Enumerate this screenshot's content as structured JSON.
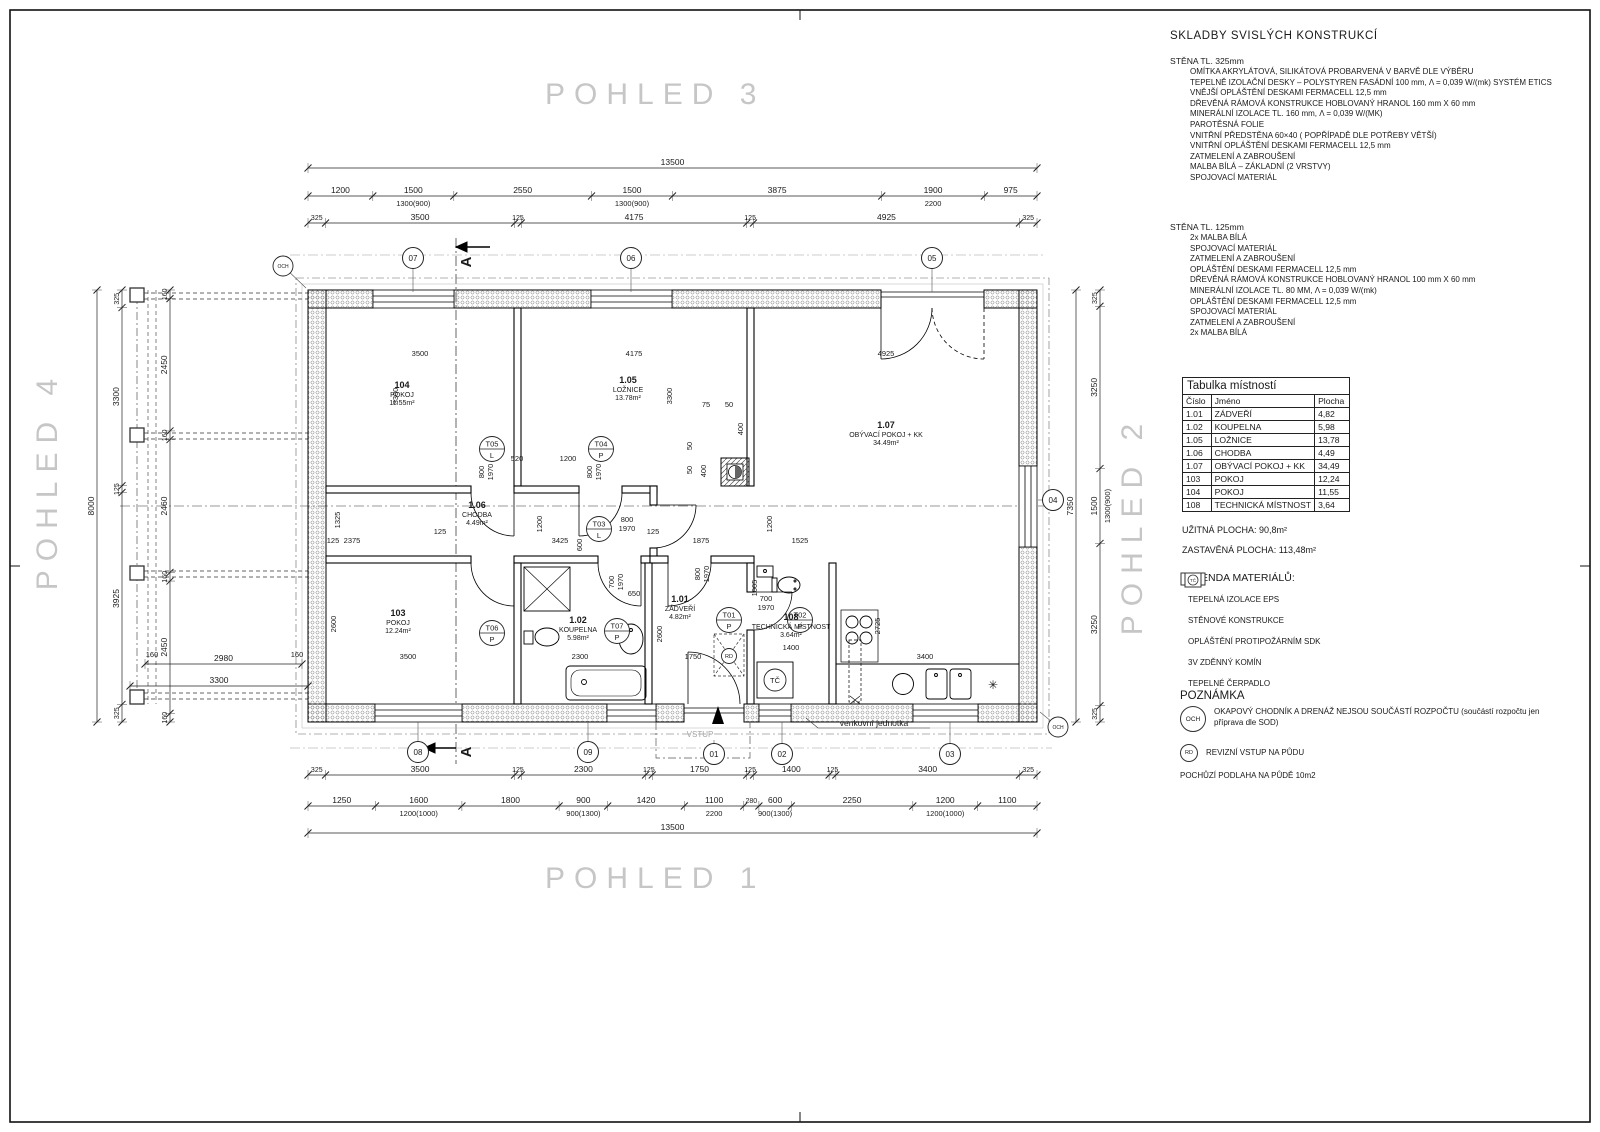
{
  "titles": {
    "view3": "POHLED 3",
    "view1": "POHLED 1",
    "view4": "POHLED 4",
    "view2": "POHLED 2"
  },
  "right_panel": {
    "skladby_title": "SKLADBY SVISLÝCH KONSTRUKCÍ",
    "wall325": {
      "heading": "STĚNA TL. 325mm",
      "lines": [
        "OMÍTKA AKRYLÁTOVÁ, SILIKÁTOVÁ PROBARVENÁ V BARVĚ DLE VÝBĚRU",
        "TEPELNĚ IZOLAČNÍ DESKY – POLYSTYREN FASÁDNÍ 100 mm, Λ = 0,039 W/(mk) SYSTÉM ETICS",
        "VNĚJŠÍ OPLÁŠTĚNÍ DESKAMI FERMACELL 12,5 mm",
        "DŘEVĚNÁ RÁMOVÁ KONSTRUKCE HOBLOVANÝ HRANOL 160 mm X 60 mm",
        "MINERÁLNÍ IZOLACE TL. 160 mm, Λ = 0,039 W/(MK)",
        "PAROTĚSNÁ FOLIE",
        "VNITŘNÍ PŘEDSTĚNA 60×40 ( POPŘÍPADĚ DLE POTŘEBY VĚTŠÍ)",
        "VNITŘNÍ OPLÁŠTĚNÍ DESKAMI FERMACELL 12,5 mm",
        "ZATMELENÍ A ZABROUŠENÍ",
        "MALBA BÍLÁ – ZÁKLADNÍ (2 VRSTVY)",
        "SPOJOVACÍ MATERIÁL"
      ]
    },
    "wall125": {
      "heading": "STĚNA TL. 125mm",
      "lines": [
        "2x MALBA BÍLÁ",
        "SPOJOVACÍ MATERIÁL",
        "ZATMELENÍ A ZABROUŠENÍ",
        "OPLÁŠTĚNÍ DESKAMI FERMACELL 12,5 mm",
        "DŘEVĚNÁ RÁMOVÁ KONSTRUKCE HOBLOVANÝ HRANOL 100 mm X 60 mm",
        "MINERÁLNÍ IZOLACE TL. 80 MM, Λ = 0,039 W/(mk)",
        "OPLÁŠTĚNÍ DESKAMI FERMACELL 12,5 mm",
        "SPOJOVACÍ MATERIÁL",
        "ZATMELENÍ A ZABROUŠENÍ",
        "2x MALBA BÍLÁ"
      ]
    },
    "room_table": {
      "title": "Tabulka místností",
      "headers": [
        "Číslo",
        "Jméno",
        "Plocha"
      ],
      "rows": [
        [
          "1.01",
          "ZÁDVEŘÍ",
          "4,82"
        ],
        [
          "1.02",
          "KOUPELNA",
          "5,98"
        ],
        [
          "1.05",
          "LOŽNICE",
          "13,78"
        ],
        [
          "1.06",
          "CHODBA",
          "4,49"
        ],
        [
          "1.07",
          "OBÝVACÍ POKOJ + KK",
          "34,49"
        ],
        [
          "103",
          "POKOJ",
          "12,24"
        ],
        [
          "104",
          "POKOJ",
          "11,55"
        ],
        [
          "108",
          "TECHNICKÁ MÍSTNOST",
          "3,64"
        ]
      ]
    },
    "area_line1": "UŽITNÁ PLOCHA:  90,8m²",
    "area_line2": "ZASTAVĚNÁ PLOCHA: 113,48m²",
    "legend": {
      "title": "LEGENDA MATERIÁLŮ:",
      "tc_symbol": "TČ",
      "items": [
        {
          "type": "eps",
          "label": "TEPELNÁ IZOLACE EPS"
        },
        {
          "type": "wall",
          "label": "STĚNOVÉ KONSTRUKCE"
        },
        {
          "type": "sdk",
          "label": "OPLÁŠTĚNÍ PROTIPOŽÁRNÍM SDK"
        },
        {
          "type": "chimney",
          "label": "3V ZDĚNNÝ KOMÍN"
        },
        {
          "type": "pump",
          "label": "TEPELNÉ ČERPADLO"
        }
      ]
    },
    "note": {
      "title": "POZNÁMKA",
      "och_badge": "OCH",
      "och_text": "OKAPOVÝ CHODNÍK A DRENÁŽ NEJSOU SOUČÁSTÍ ROZPOČTU (součástí rozpočtu jen příprava dle SOD)",
      "rd_badge": "RD",
      "rd_text": "REVIZNÍ VSTUP NA PŮDU",
      "floor_text": "POCHŮZÍ PODLAHA NA PŮDĚ 10m2"
    }
  },
  "plan": {
    "rooms": [
      {
        "id": "104",
        "name": "POKOJ",
        "area": "11.55m²",
        "x": 402,
        "y": 388
      },
      {
        "id": "1.05",
        "name": "LOŽNICE",
        "area": "13.78m²",
        "x": 628,
        "y": 383
      },
      {
        "id": "1.07",
        "name": "OBÝVACÍ POKOJ + KK",
        "area": "34.49m²",
        "x": 886,
        "y": 428
      },
      {
        "id": "1.06",
        "name": "CHODBA",
        "area": "4.49m²",
        "x": 477,
        "y": 508
      },
      {
        "id": "103",
        "name": "POKOJ",
        "area": "12.24m²",
        "x": 398,
        "y": 616
      },
      {
        "id": "1.02",
        "name": "KOUPELNA",
        "area": "5.98m²",
        "x": 578,
        "y": 623
      },
      {
        "id": "1.01",
        "name": "ZÁDVEŘÍ",
        "area": "4.82m²",
        "x": 680,
        "y": 602
      },
      {
        "id": "108",
        "name": "TECHNICKÁ MÍSTNOST",
        "area": "3.64m²",
        "x": 791,
        "y": 620
      }
    ],
    "door_tags": [
      {
        "t": "T05",
        "s": "L",
        "x": 492,
        "y": 449
      },
      {
        "t": "T04",
        "s": "P",
        "x": 601,
        "y": 449
      },
      {
        "t": "T03",
        "s": "L",
        "x": 599,
        "y": 529
      },
      {
        "t": "T06",
        "s": "P",
        "x": 492,
        "y": 633
      },
      {
        "t": "T07",
        "s": "P",
        "x": 617,
        "y": 631
      },
      {
        "t": "T01",
        "s": "P",
        "x": 729,
        "y": 620
      },
      {
        "t": "T02",
        "s": "P",
        "x": 800,
        "y": 620
      }
    ],
    "markers": [
      {
        "t": "07",
        "x": 413,
        "y": 258,
        "lx": 413,
        "ly": 292
      },
      {
        "t": "06",
        "x": 631,
        "y": 258,
        "lx": 631,
        "ly": 292
      },
      {
        "t": "05",
        "x": 932,
        "y": 258,
        "lx": 932,
        "ly": 292
      },
      {
        "t": "04",
        "x": 1053,
        "y": 500,
        "lx": 1038,
        "ly": 500
      },
      {
        "t": "08",
        "x": 418,
        "y": 752,
        "lx": 418,
        "ly": 722
      },
      {
        "t": "09",
        "x": 588,
        "y": 752,
        "lx": 588,
        "ly": 722
      },
      {
        "t": "01",
        "x": 714,
        "y": 754,
        "lx": 714,
        "ly": 740
      },
      {
        "t": "02",
        "x": 782,
        "y": 754,
        "lx": 782,
        "ly": 722
      },
      {
        "t": "03",
        "x": 950,
        "y": 754,
        "lx": 950,
        "ly": 722
      }
    ],
    "badges": [
      {
        "t": "OCH",
        "x": 283,
        "y": 266,
        "r": 10,
        "s": 5,
        "lx": 306,
        "ly": 288
      },
      {
        "t": "OCH",
        "x": 1058,
        "y": 727,
        "r": 10,
        "s": 5,
        "lx": 1040,
        "ly": 712
      },
      {
        "t": "RD",
        "x": 729,
        "y": 656,
        "r": 7.5,
        "s": 5.5
      },
      {
        "t": "TČ",
        "x": 775,
        "y": 680,
        "r": 11,
        "s": 7.5
      }
    ],
    "chains": [
      {
        "o": "h",
        "pos": 168,
        "from": 308,
        "to": 1037,
        "segs": [
          {
            "v": "13500"
          }
        ]
      },
      {
        "o": "h",
        "pos": 196,
        "from": 308,
        "to": 1037,
        "segs": [
          {
            "v": "1200"
          },
          {
            "v": "1500",
            "sub": "1300(900)"
          },
          {
            "v": "2550"
          },
          {
            "v": "1500",
            "sub": "1300(900)"
          },
          {
            "v": "3875"
          },
          {
            "v": "1900",
            "sub": "2200"
          },
          {
            "v": "975"
          }
        ]
      },
      {
        "o": "h",
        "pos": 223,
        "from": 308,
        "to": 1037,
        "segs": [
          {
            "v": "325"
          },
          {
            "v": "3500"
          },
          {
            "v": "125"
          },
          {
            "v": "4175"
          },
          {
            "v": "125"
          },
          {
            "v": "4925"
          },
          {
            "v": "325"
          }
        ]
      },
      {
        "o": "h",
        "pos": 775,
        "from": 308,
        "to": 1037,
        "segs": [
          {
            "v": "325"
          },
          {
            "v": "3500"
          },
          {
            "v": "125"
          },
          {
            "v": "2300"
          },
          {
            "v": "125"
          },
          {
            "v": "1750"
          },
          {
            "v": "125"
          },
          {
            "v": "1400"
          },
          {
            "v": "125"
          },
          {
            "v": "3400"
          },
          {
            "v": "325"
          }
        ]
      },
      {
        "o": "h",
        "pos": 806,
        "from": 308,
        "to": 1037,
        "segs": [
          {
            "v": "1250"
          },
          {
            "v": "1600",
            "sub": "1200(1000)"
          },
          {
            "v": "1800"
          },
          {
            "v": "900",
            "sub": "900(1300)"
          },
          {
            "v": "1420"
          },
          {
            "v": "1100",
            "sub": "2200"
          },
          {
            "v": "280"
          },
          {
            "v": "600",
            "sub": "900(1300)"
          },
          {
            "v": "2250"
          },
          {
            "v": "1200",
            "sub": "1200(1000)"
          },
          {
            "v": "1100"
          }
        ]
      },
      {
        "o": "h",
        "pos": 833,
        "from": 308,
        "to": 1037,
        "segs": [
          {
            "v": "13500"
          }
        ]
      },
      {
        "o": "v",
        "pos": 97,
        "from": 290,
        "to": 722,
        "segs": [
          {
            "v": "8000"
          }
        ]
      },
      {
        "o": "v",
        "pos": 122,
        "from": 290,
        "to": 722,
        "segs": [
          {
            "v": "325"
          },
          {
            "v": "3300"
          },
          {
            "v": "125"
          },
          {
            "v": "3925"
          },
          {
            "v": "325"
          }
        ]
      },
      {
        "o": "v",
        "pos": 170,
        "from": 290,
        "to": 722,
        "segs": [
          {
            "v": "160"
          },
          {
            "v": "2450"
          },
          {
            "v": "160"
          },
          {
            "v": "2460"
          },
          {
            "v": "160"
          },
          {
            "v": "2450"
          },
          {
            "v": "160"
          }
        ]
      },
      {
        "o": "v",
        "pos": 1076,
        "from": 290,
        "to": 722,
        "segs": [
          {
            "v": "7350"
          }
        ]
      },
      {
        "o": "v",
        "pos": 1100,
        "from": 290,
        "to": 722,
        "segs": [
          {
            "v": "325"
          },
          {
            "v": "3250"
          },
          {
            "v": "1500",
            "sub": "1300(900)"
          },
          {
            "v": "3250"
          },
          {
            "v": "325"
          }
        ]
      },
      {
        "o": "h",
        "pos": 664,
        "from": 145,
        "to": 302,
        "segs": [
          {
            "v": "2980"
          }
        ]
      },
      {
        "o": "h",
        "pos": 686,
        "from": 130,
        "to": 308,
        "segs": [
          {
            "v": "3300"
          }
        ]
      }
    ],
    "dims": [
      {
        "t": "3500",
        "x": 420,
        "y": 356
      },
      {
        "t": "4175",
        "x": 634,
        "y": 356
      },
      {
        "t": "4925",
        "x": 886,
        "y": 356
      },
      {
        "t": "3300",
        "x": 398,
        "y": 396,
        "r": 1
      },
      {
        "t": "3300",
        "x": 672,
        "y": 396,
        "r": 1
      },
      {
        "t": "520",
        "x": 517,
        "y": 461
      },
      {
        "t": "1200",
        "x": 568,
        "y": 461
      },
      {
        "t": "800",
        "x": 484,
        "y": 472,
        "r": 1
      },
      {
        "t": "1970",
        "x": 493,
        "y": 472,
        "r": 1
      },
      {
        "t": "800",
        "x": 592,
        "y": 472,
        "r": 1
      },
      {
        "t": "1970",
        "x": 601,
        "y": 472,
        "r": 1
      },
      {
        "t": "75",
        "x": 706,
        "y": 407
      },
      {
        "t": "50",
        "x": 729,
        "y": 407
      },
      {
        "t": "400",
        "x": 743,
        "y": 429,
        "r": 1
      },
      {
        "t": "50",
        "x": 692,
        "y": 446,
        "r": 1
      },
      {
        "t": "400",
        "x": 706,
        "y": 471,
        "r": 1
      },
      {
        "t": "50",
        "x": 692,
        "y": 470,
        "r": 1
      },
      {
        "t": "1325",
        "x": 340,
        "y": 520,
        "r": 1
      },
      {
        "t": "2375",
        "x": 352,
        "y": 543
      },
      {
        "t": "125",
        "x": 440,
        "y": 534
      },
      {
        "t": "3425",
        "x": 560,
        "y": 543
      },
      {
        "t": "1875",
        "x": 701,
        "y": 543
      },
      {
        "t": "1525",
        "x": 800,
        "y": 543
      },
      {
        "t": "1200",
        "x": 542,
        "y": 524,
        "r": 1
      },
      {
        "t": "1200",
        "x": 772,
        "y": 524,
        "r": 1
      },
      {
        "t": "800",
        "x": 627,
        "y": 522
      },
      {
        "t": "1970",
        "x": 627,
        "y": 531
      },
      {
        "t": "125",
        "x": 653,
        "y": 534
      },
      {
        "t": "600",
        "x": 582,
        "y": 545,
        "r": 1
      },
      {
        "t": "800",
        "x": 700,
        "y": 574,
        "r": 1
      },
      {
        "t": "1970",
        "x": 709,
        "y": 574,
        "r": 1
      },
      {
        "t": "700",
        "x": 614,
        "y": 582,
        "r": 1
      },
      {
        "t": "1970",
        "x": 623,
        "y": 582,
        "r": 1
      },
      {
        "t": "650",
        "x": 634,
        "y": 596
      },
      {
        "t": "700",
        "x": 766,
        "y": 601
      },
      {
        "t": "1970",
        "x": 766,
        "y": 610
      },
      {
        "t": "1005",
        "x": 757,
        "y": 588,
        "r": 1
      },
      {
        "t": "2600",
        "x": 336,
        "y": 624,
        "r": 1
      },
      {
        "t": "2600",
        "x": 662,
        "y": 634,
        "r": 1
      },
      {
        "t": "3500",
        "x": 408,
        "y": 659
      },
      {
        "t": "2300",
        "x": 580,
        "y": 659
      },
      {
        "t": "1750",
        "x": 693,
        "y": 659
      },
      {
        "t": "1400",
        "x": 791,
        "y": 650
      },
      {
        "t": "3400",
        "x": 925,
        "y": 659
      },
      {
        "t": "2725",
        "x": 880,
        "y": 626,
        "r": 1
      },
      {
        "t": "160",
        "x": 152,
        "y": 657
      },
      {
        "t": "160",
        "x": 297,
        "y": 657
      },
      {
        "t": "125",
        "x": 333,
        "y": 543
      }
    ],
    "labels": [
      {
        "t": "VSTUP",
        "x": 700,
        "y": 737,
        "c": "#a6a6a6",
        "s": 8
      },
      {
        "t": "venkovní jednotka",
        "x": 874,
        "y": 726,
        "s": 8.5
      },
      {
        "t": "A",
        "x": 471,
        "y": 262,
        "s": 15,
        "b": 1,
        "r": 1
      },
      {
        "t": "A",
        "x": 471,
        "y": 752,
        "s": 15,
        "b": 1,
        "r": 1
      },
      {
        "t": "✳",
        "x": 993,
        "y": 689,
        "s": 12
      }
    ]
  }
}
